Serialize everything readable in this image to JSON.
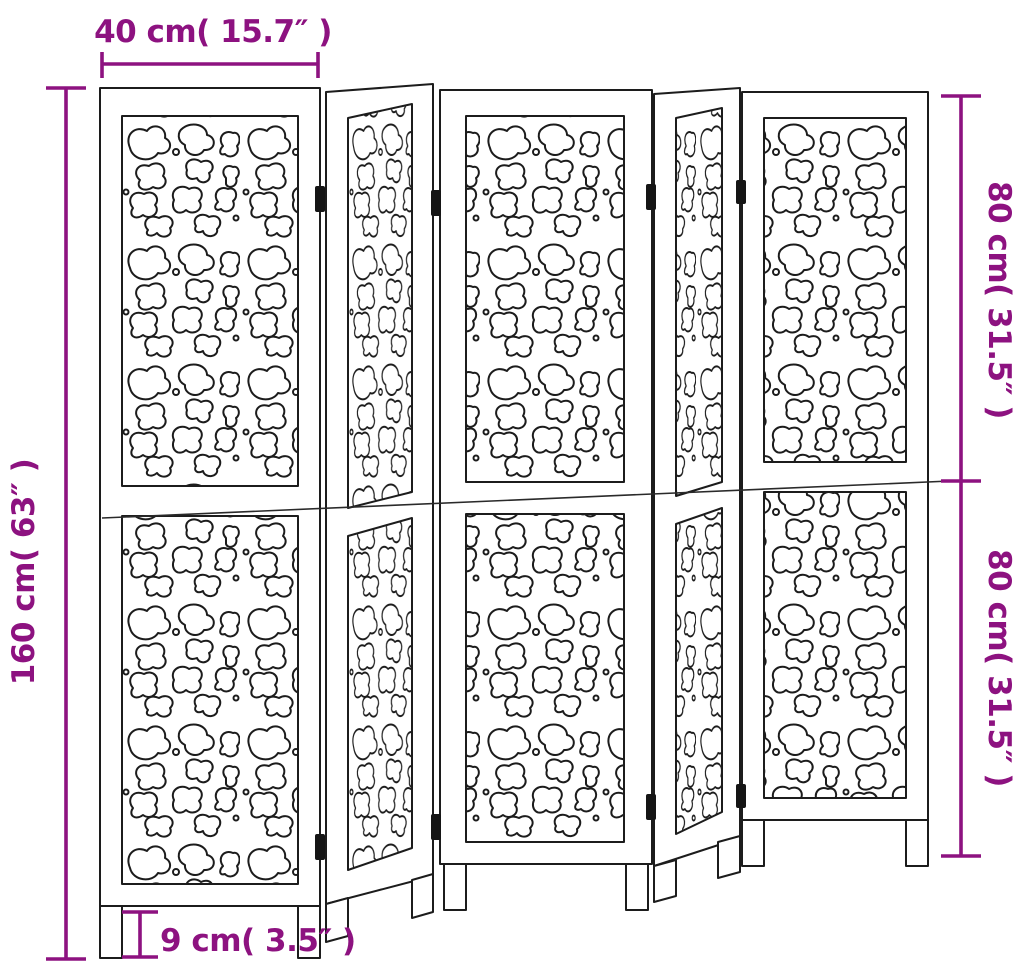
{
  "diagram": {
    "kind": "product-dimension-drawing",
    "subject": "5-panel folding room divider with decorative cut-out panels",
    "panel_count": 5
  },
  "colors": {
    "annotation": "#8d1280",
    "line_art": "#1c1c1c",
    "background": "#ffffff"
  },
  "dimensions": {
    "top_width": {
      "label": "40 cm( 15.7″ )",
      "value_cm": 40,
      "value_inches": 15.7
    },
    "left_total_height": {
      "label": "160 cm( 63″ )",
      "value_cm": 160,
      "value_inches": 63
    },
    "right_upper_height": {
      "label": "80 cm( 31.5″ )",
      "value_cm": 80,
      "value_inches": 31.5
    },
    "right_lower_height": {
      "label": "80 cm( 31.5″ )",
      "value_cm": 80,
      "value_inches": 31.5
    },
    "leg_height": {
      "label": "9 cm( 3.5″ )",
      "value_cm": 9,
      "value_inches": 3.5
    }
  }
}
